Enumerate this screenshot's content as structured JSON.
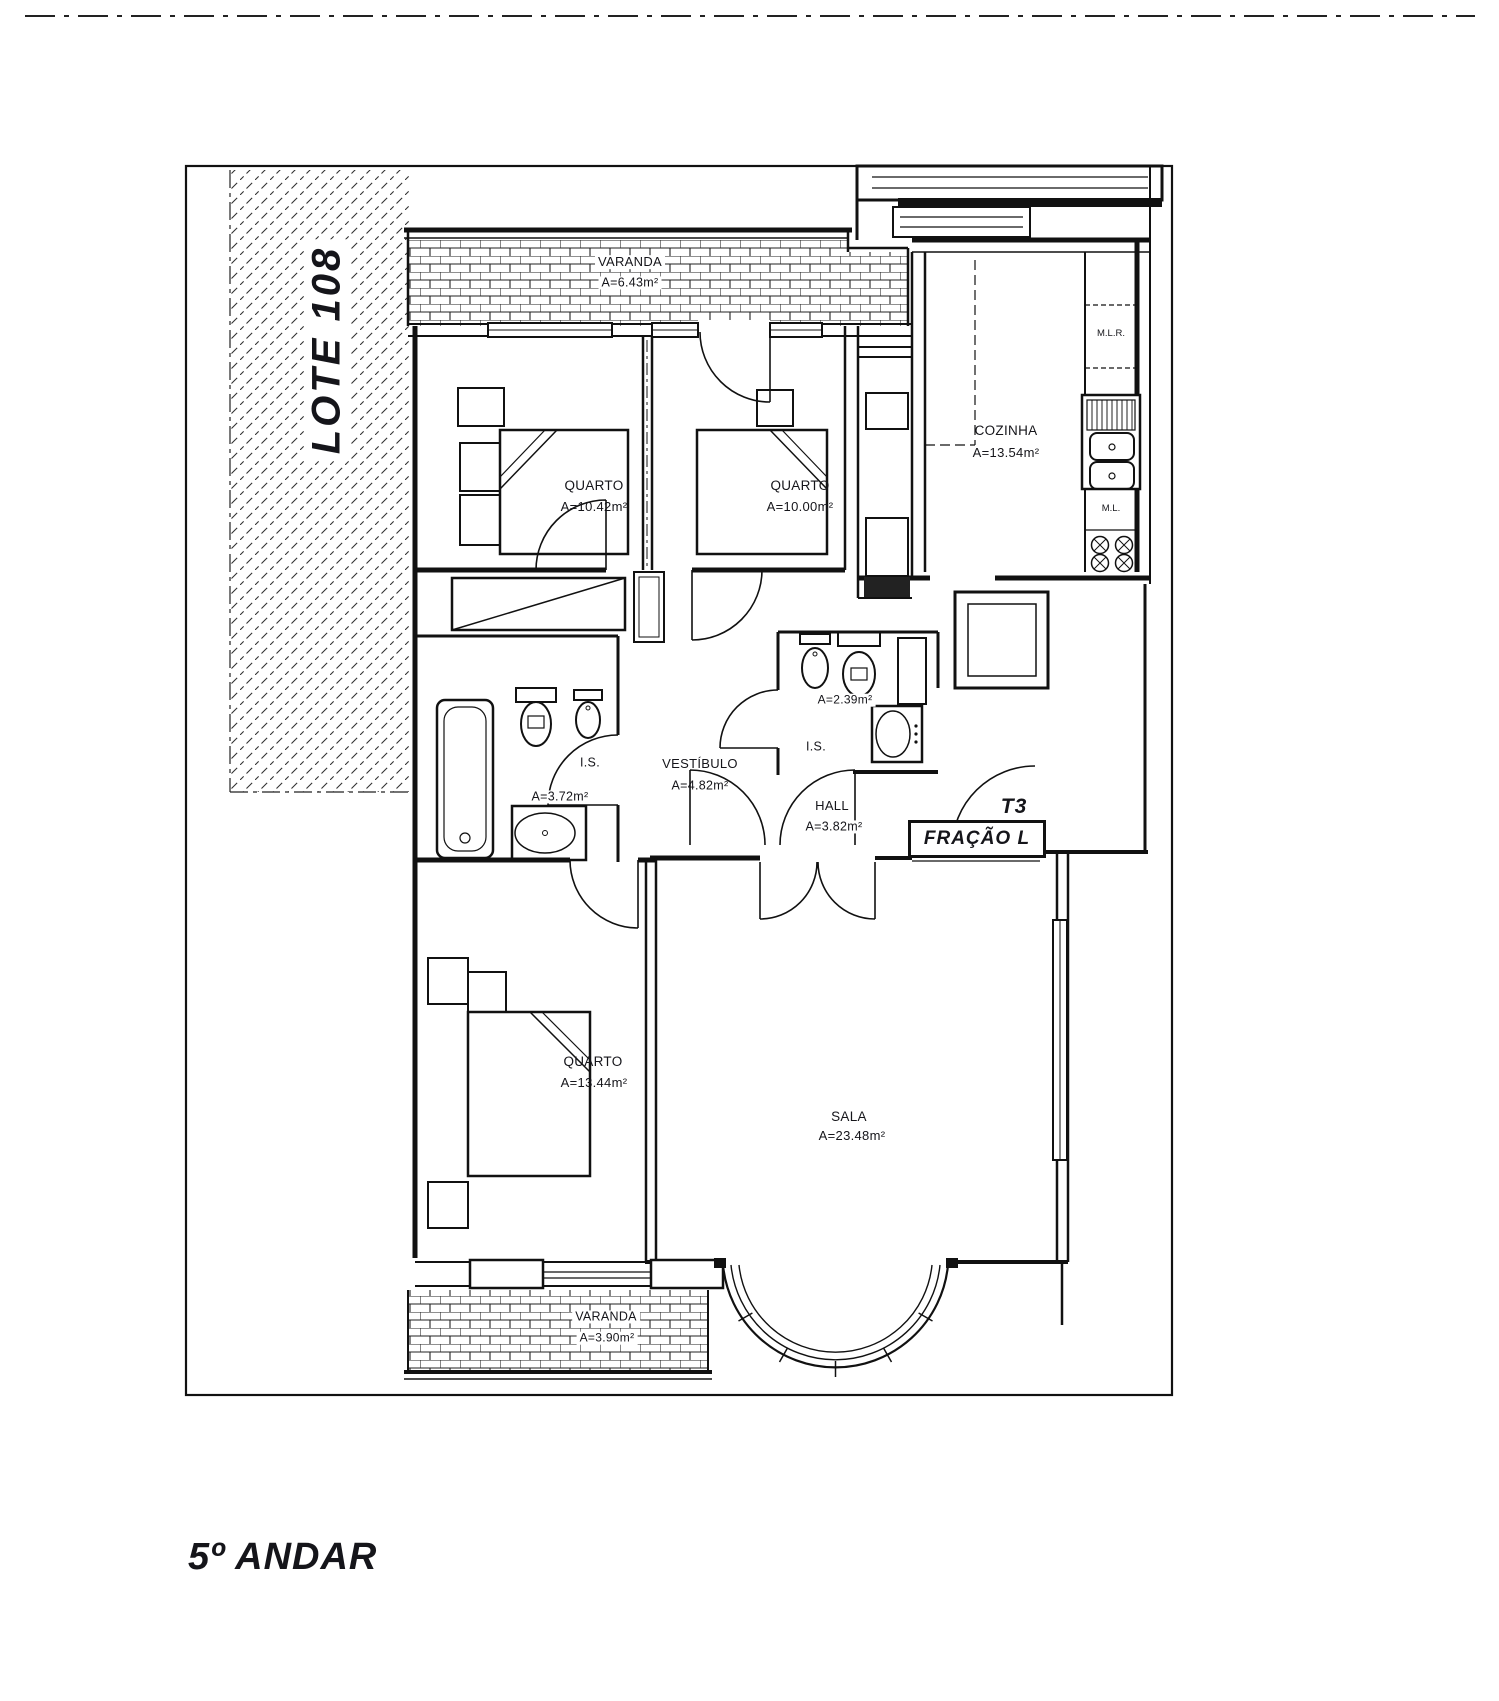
{
  "page_title": "5º ANDAR",
  "lot": {
    "label": "LOTE 108"
  },
  "unit": {
    "type": "T3",
    "fraction": "FRAÇÃO L"
  },
  "rooms": {
    "varanda_top": {
      "name": "VARANDA",
      "area": "A=6.43m²"
    },
    "quarto_1": {
      "name": "QUARTO",
      "area": "A=10.42m²"
    },
    "quarto_2": {
      "name": "QUARTO",
      "area": "A=10.00m²"
    },
    "cozinha": {
      "name": "COZINHA",
      "area": "A=13.54m²"
    },
    "is_1": {
      "name": "I.S.",
      "area": "A=3.72m²"
    },
    "vestibulo": {
      "name": "VESTÍBULO",
      "area": "A=4.82m²"
    },
    "is_2": {
      "name": "I.S.",
      "area": "A=2.39m²"
    },
    "hall": {
      "name": "HALL",
      "area": "A=3.82m²"
    },
    "quarto_3": {
      "name": "QUARTO",
      "area": "A=13.44m²"
    },
    "sala": {
      "name": "SALA",
      "area": "A=23.48m²"
    },
    "varanda_bottom": {
      "name": "VARANDA",
      "area": "A=3.90m²"
    }
  },
  "kitchen_appliances": {
    "washing_machine": "M.L.R.",
    "dishwasher": "M.L."
  },
  "colors": {
    "ink": "#15151a",
    "paper": "#ffffff"
  }
}
